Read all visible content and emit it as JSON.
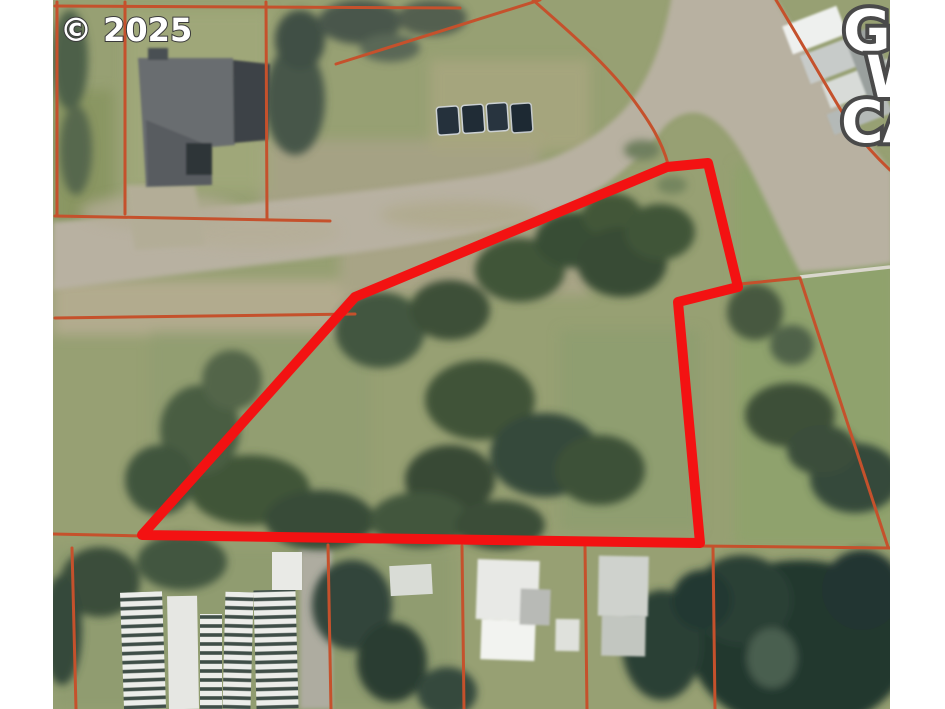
{
  "watermark": {
    "text": "© 2025"
  },
  "labels": {
    "line1": "GE",
    "line2": "W",
    "line3": "CA"
  },
  "colors": {
    "subject_outline": "#f31212",
    "parcel_lines": "#c5512c",
    "label_fill": "#ffffff",
    "label_stroke": "#4a4a4a",
    "background": "#ffffff"
  }
}
